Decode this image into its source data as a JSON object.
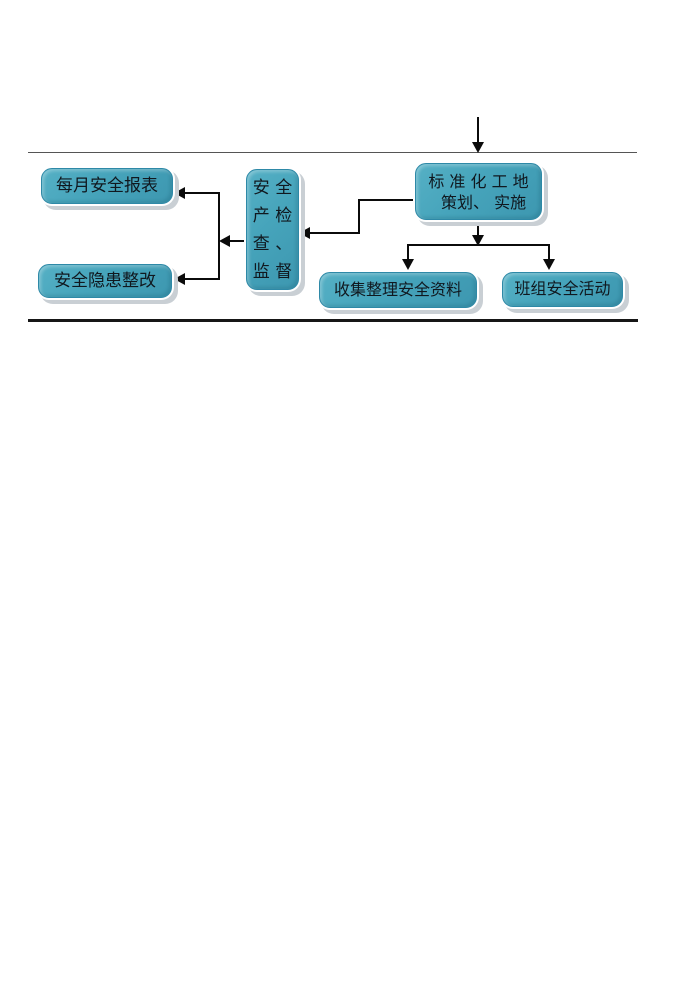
{
  "diagram": {
    "boxes": {
      "plan": {
        "label": "标 准 化 工 地\n  策划、 实施"
      },
      "inspect": {
        "label": "安 全\n产 检\n查 、\n监 督"
      },
      "monthly_report": {
        "label": "每月安全报表"
      },
      "hazard_fix": {
        "label": "安全隐患整改"
      },
      "collect_data": {
        "label": "收集整理安全资料"
      },
      "team_activity": {
        "label": "班组安全活动"
      }
    },
    "colors": {
      "box_fill": "#46a4bb",
      "box_border": "#2e89a7",
      "box_shadow_color": "#c9cfd4",
      "arrow_color": "#0b0b0b",
      "text_color": "#10181f",
      "rule_top_color": "#555555",
      "rule_bottom_color": "#161616"
    }
  }
}
